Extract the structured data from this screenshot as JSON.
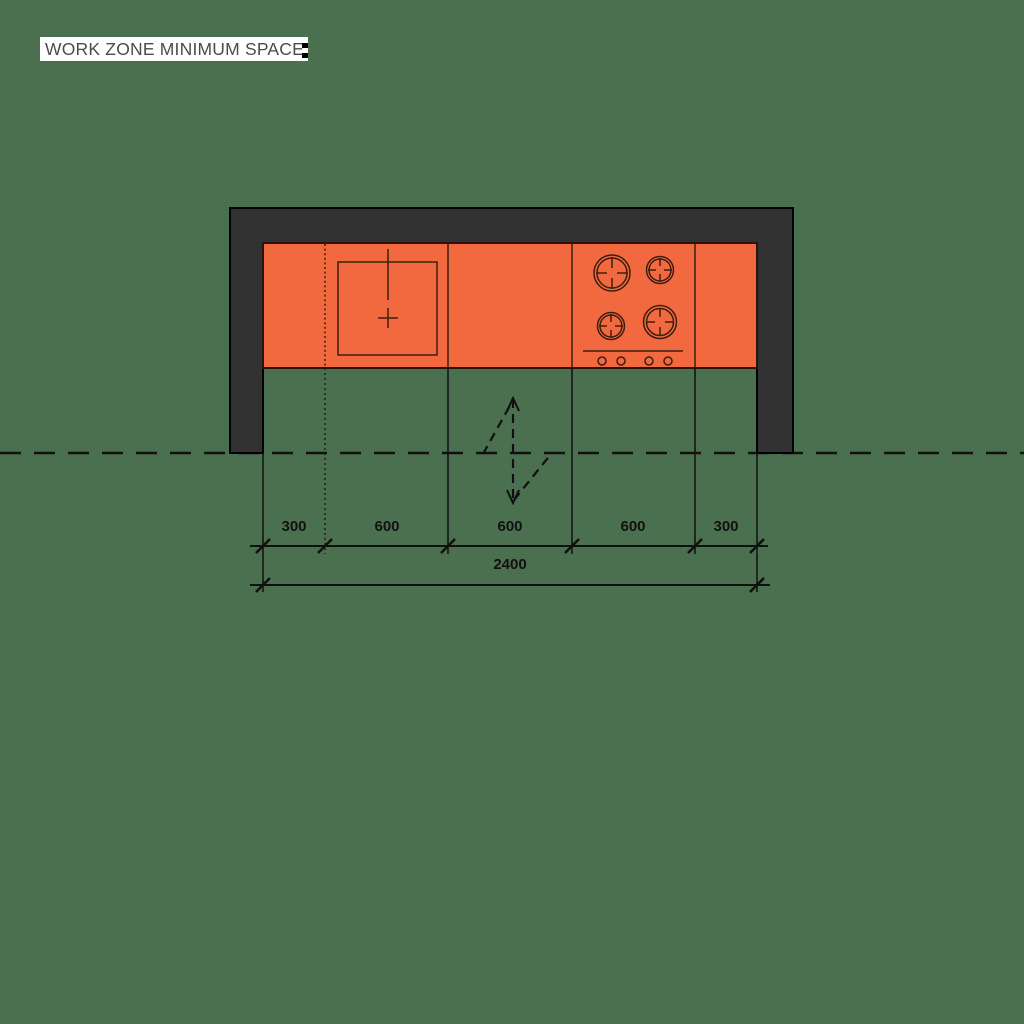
{
  "title": "WORK ZONE MINIMUM SPACE",
  "colors": {
    "background": "#4b7050",
    "countertop": "#f2693f",
    "wall": "#323232",
    "line": "#101010",
    "title_text": "#4c4c4c",
    "title_background": "#ffffff"
  },
  "dimensions": {
    "segments": [
      "300",
      "600",
      "600",
      "600",
      "300"
    ],
    "total": "2400"
  },
  "icons": {
    "sink": "sink-plan-icon",
    "cooktop": "cooktop-4-burner-icon",
    "swing_arrow": "work-zone-swing-arrow-icon"
  }
}
